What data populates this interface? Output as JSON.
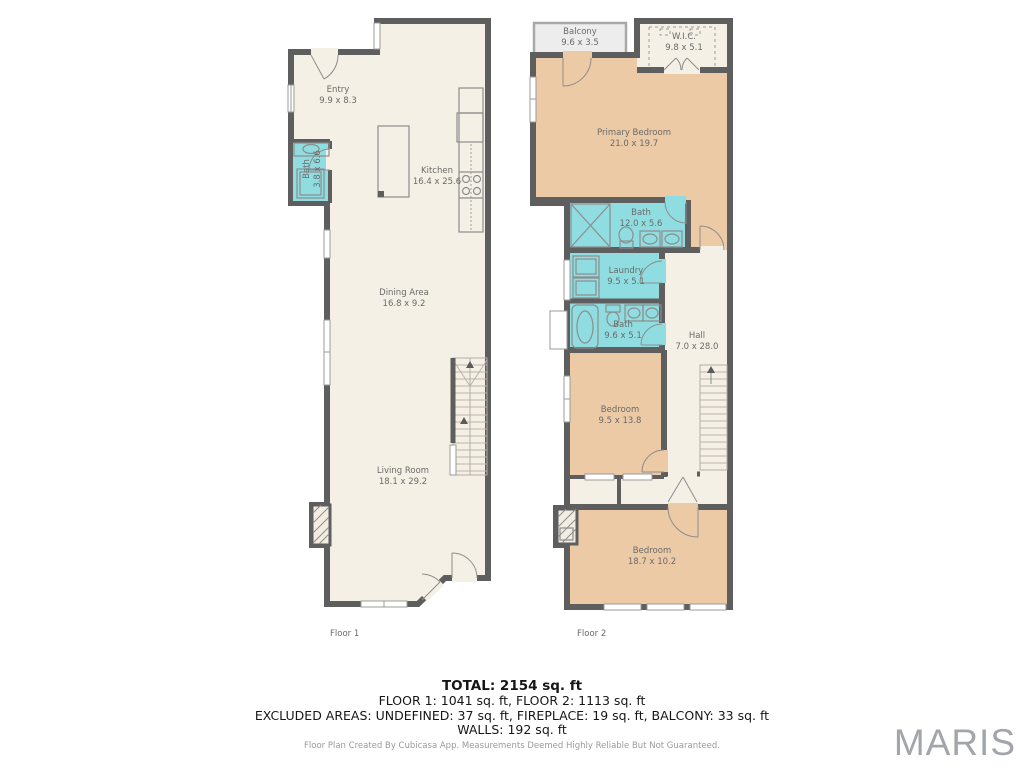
{
  "colors": {
    "wall": "#5e5e5e",
    "floor": "#f5f0e6",
    "bedroom_floor": "#eccaa6",
    "wet_floor": "#8fdde1",
    "balcony_floor": "#ededed",
    "label_text": "#6a6a6a",
    "watermark_text": "#a2a6ab"
  },
  "floors": [
    {
      "label": "Floor 1",
      "rooms": [
        {
          "name": "Entry",
          "dims": "9.9 x 8.3"
        },
        {
          "name": "Bath",
          "dims": "3.8 x 6.6"
        },
        {
          "name": "Kitchen",
          "dims": "16.4 x 25.6"
        },
        {
          "name": "Dining Area",
          "dims": "16.8 x 9.2"
        },
        {
          "name": "Living Room",
          "dims": "18.1 x 29.2"
        }
      ]
    },
    {
      "label": "Floor 2",
      "rooms": [
        {
          "name": "Balcony",
          "dims": "9.6 x 3.5"
        },
        {
          "name": "W.I.C.",
          "dims": "9.8 x 5.1"
        },
        {
          "name": "Primary Bedroom",
          "dims": "21.0 x 19.7"
        },
        {
          "name": "Bath",
          "dims": "12.0 x 5.6"
        },
        {
          "name": "Laundry",
          "dims": "9.5 x 5.1"
        },
        {
          "name": "Bath",
          "dims": "9.6 x 5.1"
        },
        {
          "name": "Hall",
          "dims": "7.0 x 28.0"
        },
        {
          "name": "Bedroom",
          "dims": "9.5 x 13.8"
        },
        {
          "name": "Bedroom",
          "dims": "18.7 x 10.2"
        }
      ]
    }
  ],
  "summary": {
    "total": "TOTAL: 2154 sq. ft",
    "floors_line": "FLOOR 1: 1041 sq. ft, FLOOR 2: 1113 sq. ft",
    "excluded": "EXCLUDED AREAS: UNDEFINED: 37 sq. ft, FIREPLACE: 19 sq. ft, BALCONY: 33 sq. ft",
    "walls": "WALLS: 192 sq. ft"
  },
  "disclaimer": "Floor Plan Created By Cubicasa App. Measurements Deemed Highly Reliable But Not Guaranteed.",
  "watermark": "MARIS"
}
